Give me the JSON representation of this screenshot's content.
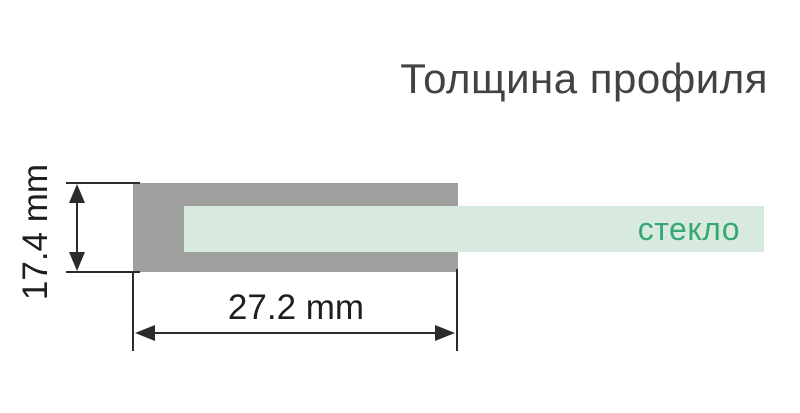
{
  "title": "Толщина профиля",
  "colors": {
    "background": "#ffffff",
    "title_color": "#424242",
    "profile_color": "#9f9f9d",
    "glass_color": "#d8e9e0",
    "glass_label_color": "#36a873",
    "dim_line_color": "#2b2b2b",
    "dim_text_color": "#1e1e1e"
  },
  "diagram": {
    "glass_label": "стекло",
    "height_dimension": "17.4 mm",
    "width_dimension": "27.2 mm"
  }
}
